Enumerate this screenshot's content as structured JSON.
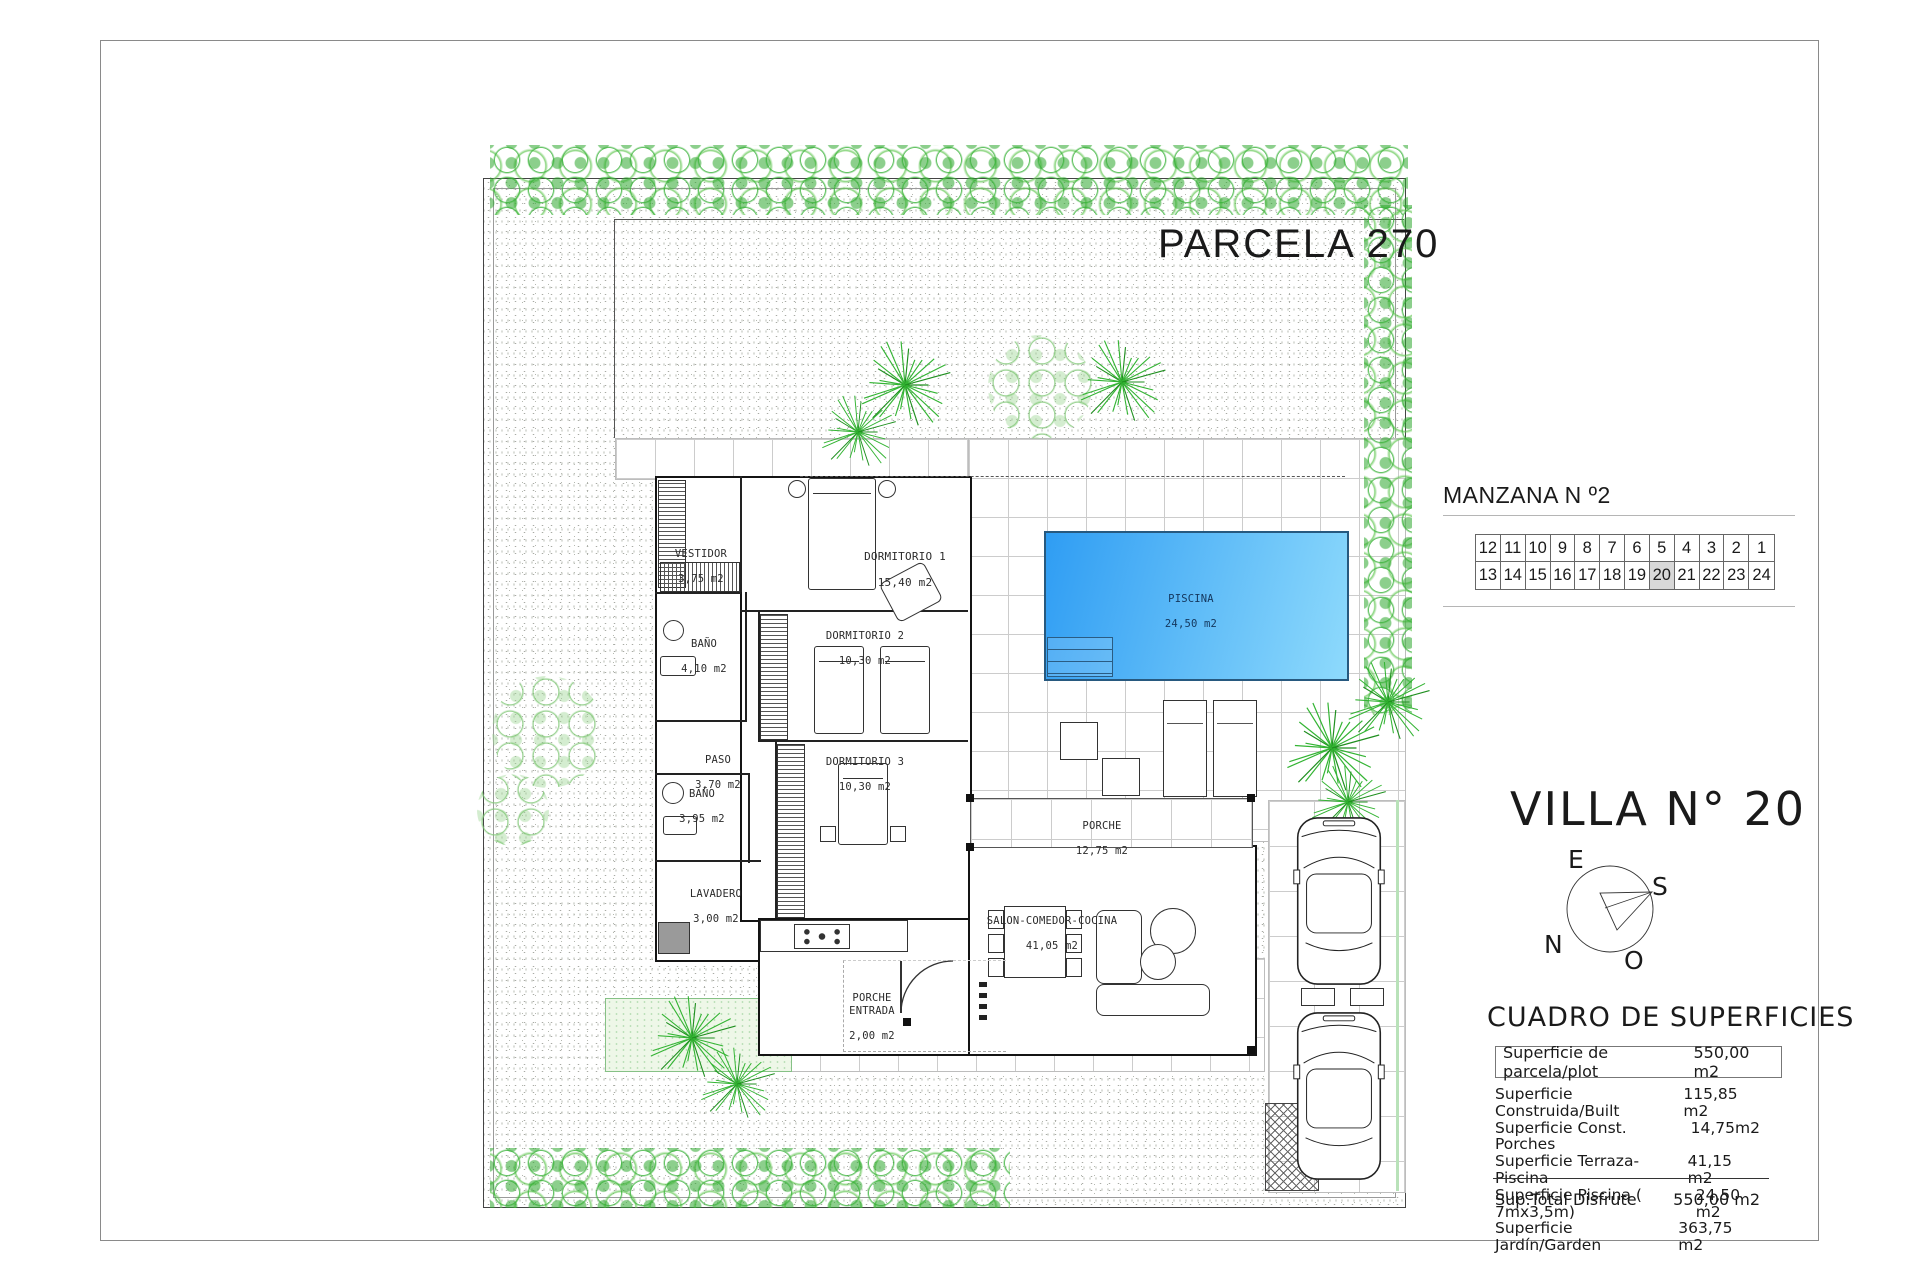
{
  "titles": {
    "parcel": "PARCELA 270",
    "block": "MANZANA N º2",
    "villa": "VILLA N° 20",
    "surfaces": "CUADRO DE SUPERFICIES"
  },
  "lot_grid": {
    "row1": [
      "12",
      "11",
      "10",
      "9",
      "8",
      "7",
      "6",
      "5",
      "4",
      "3",
      "2",
      "1"
    ],
    "row2": [
      "13",
      "14",
      "15",
      "16",
      "17",
      "18",
      "19",
      "20",
      "21",
      "22",
      "23",
      "24"
    ],
    "highlight": "20"
  },
  "compass": {
    "top": "E",
    "right": "S",
    "left": "N",
    "bottom": "O"
  },
  "surfaces_table": {
    "plot_row": {
      "label": "Superficie de parcela/plot",
      "value": "550,00 m2"
    },
    "rows": [
      {
        "label": "Superficie Construida/Built",
        "value": "115,85 m2"
      },
      {
        "label": "Superficie Const. Porches",
        "value": "14,75m2"
      },
      {
        "label": "Superficie Terraza-Piscina",
        "value": "41,15 m2"
      },
      {
        "label": "Superficie Piscina ( 7mx3,5m)",
        "value": "24,50 m2"
      },
      {
        "label": "Superficie Jardín/Garden",
        "value": "363,75 m2"
      }
    ],
    "total_row": {
      "label": "Sup.Total Disfrute",
      "value": "550,00 m2"
    }
  },
  "rooms": {
    "vestidor": {
      "label": "VESTIDOR",
      "area": "3,75 m2"
    },
    "dormitorio1": {
      "label": "DORMITORIO 1",
      "area": "15,40 m2"
    },
    "bano1": {
      "label": "BAÑO",
      "area": "4,10 m2"
    },
    "dormitorio2": {
      "label": "DORMITORIO 2",
      "area": "10,30 m2"
    },
    "paso": {
      "label": "PASO",
      "area": "3,70 m2"
    },
    "dormitorio3": {
      "label": "DORMITORIO 3",
      "area": "10,30 m2"
    },
    "bano2": {
      "label": "BAÑO",
      "area": "3,95 m2"
    },
    "lavadero": {
      "label": "LAVADERO",
      "area": "3,00 m2"
    },
    "porche_entrada": {
      "label": "PORCHE ENTRADA",
      "area": "2,00 m2"
    },
    "salon": {
      "label": "SALON-COMEDOR-COCINA",
      "area": "41,05 m2"
    },
    "porche": {
      "label": "PORCHE",
      "area": "12,75 m2"
    },
    "piscina": {
      "label": "PISCINA",
      "area": "24,50 m2"
    }
  },
  "colors": {
    "pool_start": "#2f9df3",
    "pool_end": "#8edafc",
    "highlight_cell": "#d8d8d8",
    "shrub_green": "#38b238"
  }
}
